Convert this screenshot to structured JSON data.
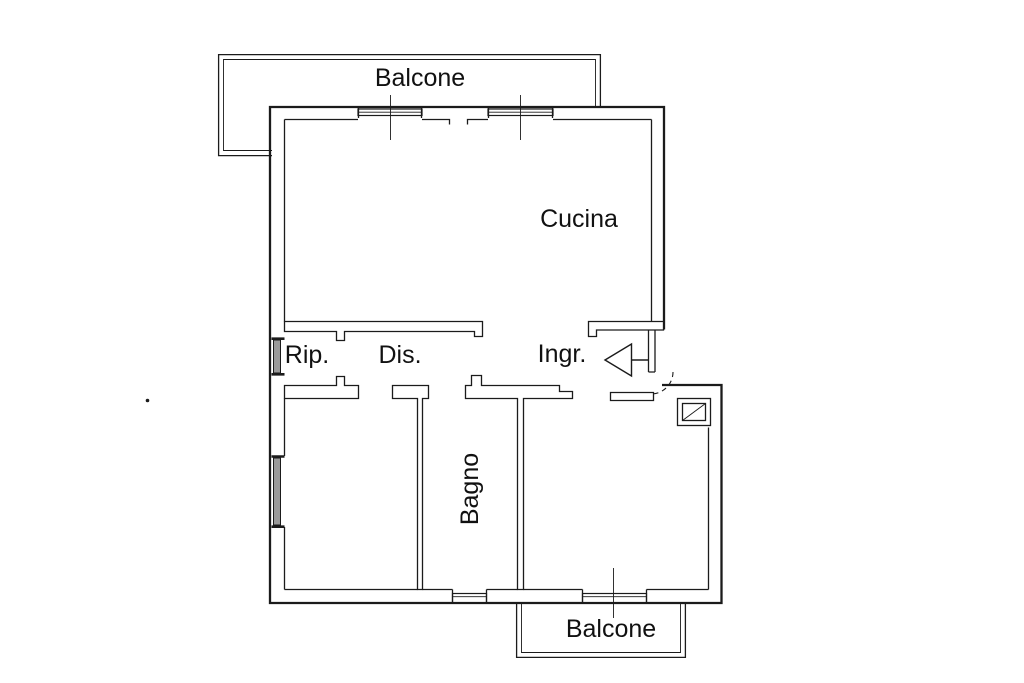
{
  "canvas": {
    "background": "#ffffff",
    "line_color": "#1b1b1b",
    "window_fill": "#9a9a9a",
    "text_color": "#111111"
  },
  "floor_plan": {
    "labels": {
      "balcone_top": "Balcone",
      "cucina": "Cucina",
      "rip": "Rip.",
      "dis": "Dis.",
      "ingr": "Ingr.",
      "bagno": "Bagno",
      "balcone_bottom": "Balcone"
    },
    "symbols": {
      "entrance_arrow": "entrance-direction-arrow",
      "door_swing": "door-swing-arc",
      "shaft": "shaft-square-with-diagonal"
    }
  }
}
